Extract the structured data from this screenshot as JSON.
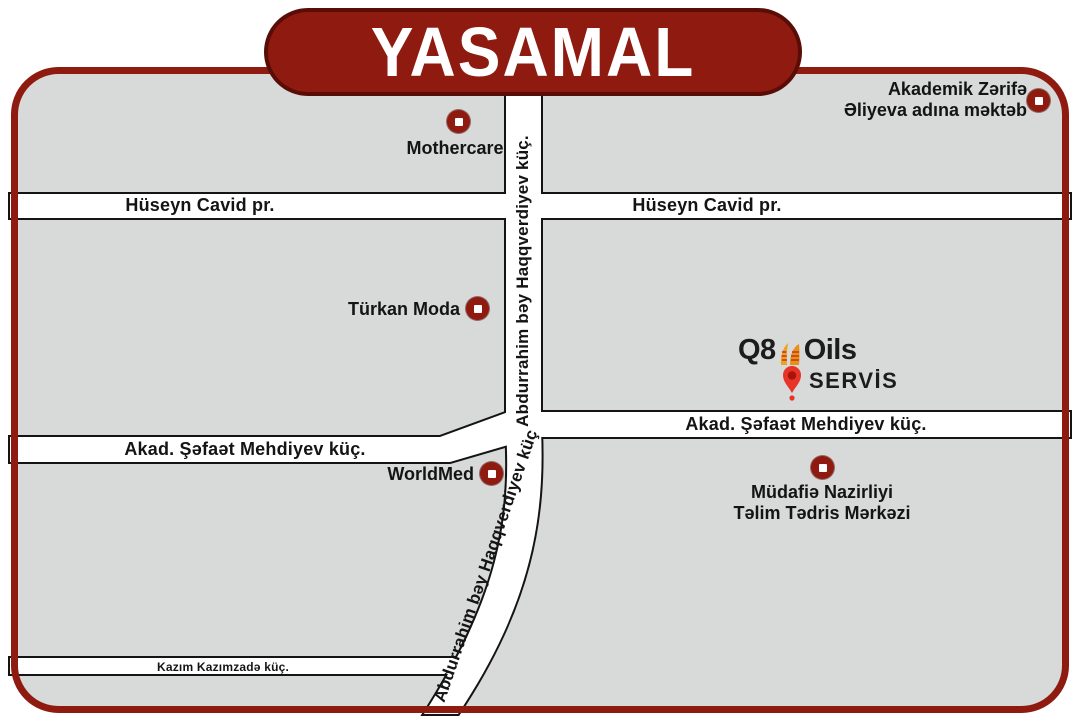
{
  "title": {
    "text": "YASAMAL"
  },
  "colors": {
    "accent": "#8e1a10",
    "banner_edge": "#5a0d07",
    "map_fill": "#d8d9d9",
    "street_edge": "#141414",
    "pin_red": "#e63428"
  },
  "streets": {
    "huseyn_cavid_left": "Hüseyn Cavid pr.",
    "huseyn_cavid_right": "Hüseyn Cavid pr.",
    "haqqverdiyev_upper": "Abdurrahim bəy Haqqverdiyev küç.",
    "haqqverdiyev_lower": "Abdurrahim bəy Haqqverdiyev küç",
    "mehdiyev_left": "Akad. Şəfaət Mehdiyev küç.",
    "mehdiyev_right": "Akad. Şəfaət Mehdiyev küç.",
    "kazimzade": "Kazım Kazımzadə küç."
  },
  "landmarks": {
    "mothercare": {
      "label": "Mothercare"
    },
    "school": {
      "line1": "Akademik Zərifə",
      "line2": "Əliyeva adına məktəb"
    },
    "turkan_moda": {
      "label": "Türkan Moda"
    },
    "worldmed": {
      "label": "WorldMed"
    },
    "mudafie": {
      "line1": "Müdafiə Nazirliyi",
      "line2": "Təlim Tədris Mərkəzi"
    }
  },
  "logo": {
    "brand_q8": "Q8",
    "brand_oils": "Oils",
    "subtitle": "SERVİS"
  }
}
